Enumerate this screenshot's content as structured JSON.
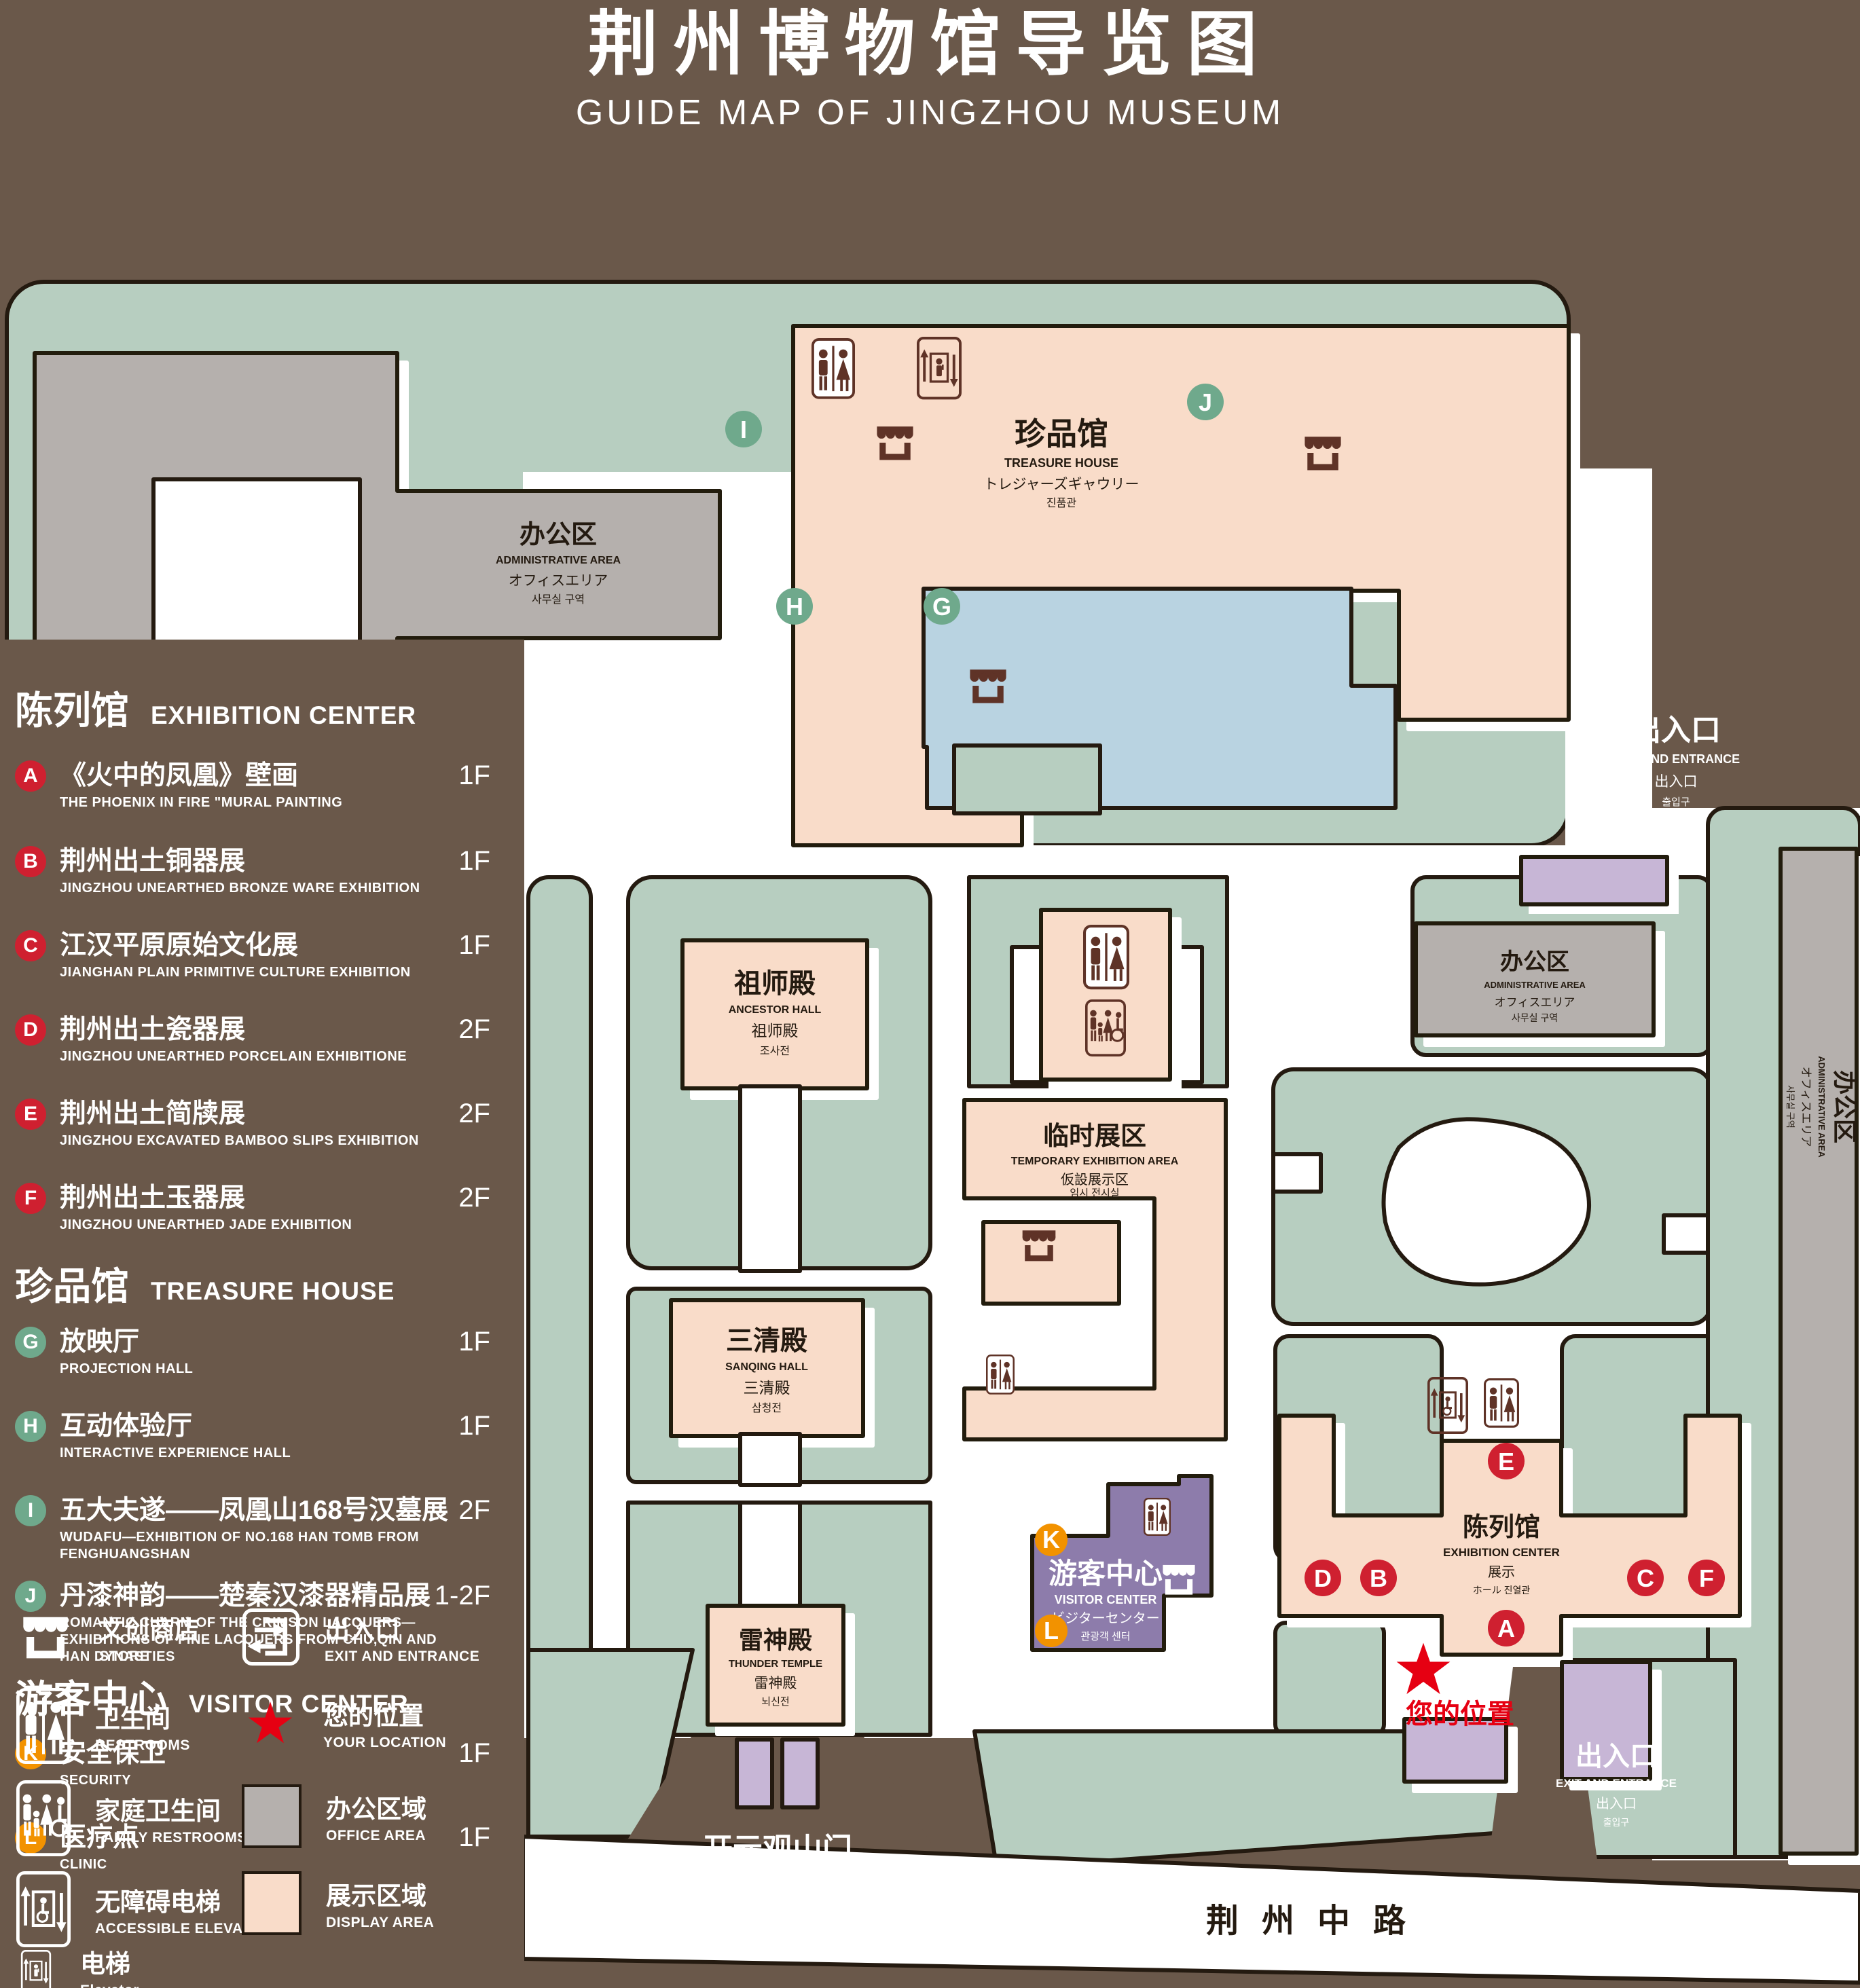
{
  "title": {
    "zh": "荆州博物馆导览图",
    "en": "GUIDE MAP OF JINGZHOU MUSEUM"
  },
  "sidebar": {
    "sections": [
      {
        "zh": "陈列馆",
        "en": "EXHIBITION CENTER"
      },
      {
        "zh": "珍品馆",
        "en": "TREASURE HOUSE"
      },
      {
        "zh": "游客中心",
        "en": "VISITOR CENTER"
      }
    ],
    "items": [
      {
        "letter": "A",
        "zh": "《火中的凤凰》壁画",
        "en": "THE PHOENIX IN FIRE \"MURAL PAINTING",
        "floor": "1F"
      },
      {
        "letter": "B",
        "zh": "荆州出土铜器展",
        "en": "JINGZHOU UNEARTHED BRONZE WARE EXHIBITION",
        "floor": "1F"
      },
      {
        "letter": "C",
        "zh": "江汉平原原始文化展",
        "en": "JIANGHAN PLAIN PRIMITIVE CULTURE EXHIBITION",
        "floor": "1F"
      },
      {
        "letter": "D",
        "zh": "荆州出土瓷器展",
        "en": "JINGZHOU UNEARTHED PORCELAIN EXHIBITIONE",
        "floor": "2F"
      },
      {
        "letter": "E",
        "zh": "荆州出土简牍展",
        "en": "JINGZHOU EXCAVATED BAMBOO SLIPS EXHIBITION",
        "floor": "2F"
      },
      {
        "letter": "F",
        "zh": "荆州出土玉器展",
        "en": "JINGZHOU UNEARTHED JADE EXHIBITION",
        "floor": "2F"
      },
      {
        "letter": "G",
        "zh": "放映厅",
        "en": "PROJECTION HALL",
        "floor": "1F"
      },
      {
        "letter": "H",
        "zh": "互动体验厅",
        "en": "INTERACTIVE EXPERIENCE HALL",
        "floor": "1F"
      },
      {
        "letter": "I",
        "zh": "五大夫遂——凤凰山168号汉墓展",
        "en": "WUDAFU—EXHIBITION OF NO.168 HAN TOMB FROM FENGHUANGSHAN",
        "floor": "2F"
      },
      {
        "letter": "J",
        "zh": "丹漆神韵——楚秦汉漆器精品展",
        "en": "ROMANTIC CHARM OF THE CRIMSON LACQUERS—EXHIBITIONS OF FINE LACQUERS FROM CHU,QIN AND HAN DYNASTIES",
        "floor": "1-2F"
      },
      {
        "letter": "K",
        "zh": "安全保卫",
        "en": "SECURITY",
        "floor": "1F"
      },
      {
        "letter": "L",
        "zh": "医疗点",
        "en": "CLINIC",
        "floor": "1F"
      }
    ]
  },
  "legend": {
    "store": {
      "zh": "文创商店",
      "en": "STORE"
    },
    "restrooms": {
      "zh": "卫生间",
      "en": "RESTROOMS"
    },
    "family_restrooms": {
      "zh": "家庭卫生间",
      "en": "FAMILY RESTROOMS"
    },
    "accessible_elevator": {
      "zh": "无障碍电梯",
      "en": "ACCESSIBLE  ELEVATOR"
    },
    "elevator": {
      "zh": "电梯",
      "en": "Elevator"
    },
    "exit": {
      "zh": "出入口",
      "en": "EXIT AND ENTRANCE"
    },
    "your_location": {
      "zh": "您的位置",
      "en": "YOUR LOCATION"
    },
    "office_area": {
      "zh": "办公区域",
      "en": "OFFICE AREA"
    },
    "display_area": {
      "zh": "展示区域",
      "en": "DISPLAY AREA"
    }
  },
  "map": {
    "admin_area": {
      "zh": "办公区",
      "en": "ADMINISTRATIVE AREA",
      "ja": "オフィスエリア",
      "ko": "사무실 구역"
    },
    "treasure_house": {
      "zh": "珍品馆",
      "en": "TREASURE HOUSE",
      "ja": "トレジャーズギャウリー",
      "ko": "진품관"
    },
    "ancestor_hall": {
      "zh": "祖师殿",
      "en": "ANCESTOR HALL",
      "ja": "祖师殿",
      "ko": "조사전"
    },
    "sanqing_hall": {
      "zh": "三清殿",
      "en": "SANQING HALL",
      "ja": "三清殿",
      "ko": "삼청전"
    },
    "thunder_temple": {
      "zh": "雷神殿",
      "en": "THUNDER TEMPLE",
      "ja": "雷神殿",
      "ko": "뇌신전"
    },
    "temporary_area": {
      "zh": "临时展区",
      "en": "TEMPORARY EXHIBITION AREA",
      "ja": "仮設展示区",
      "ko": "임시 전시실"
    },
    "visitor_center": {
      "zh": "游客中心",
      "en": "VISITOR CENTER",
      "ja": "ビジターセンター",
      "ko": "관광객 센터"
    },
    "exhibition_center": {
      "zh": "陈列馆",
      "en": "EXHIBITION CENTER",
      "ja": "展示",
      "ko": "ホール 진열관"
    },
    "gate": {
      "zh": "开元观山门",
      "en": "KAIYUAN TEMPLE GATE",
      "ja": "開元観山門",
      "ko": "산문을 열다"
    },
    "exit": {
      "zh": "出入口",
      "en": "EXIT AND ENTRANCE",
      "ja": "出入口",
      "ko": "출입구"
    },
    "your_location": "您的位置",
    "road": "荆州中路",
    "markers": {
      "a": "A",
      "b": "B",
      "c": "C",
      "d": "D",
      "e": "E",
      "f": "F",
      "g": "G",
      "h": "H",
      "i": "I",
      "j": "J",
      "k": "K",
      "l": "L"
    }
  }
}
